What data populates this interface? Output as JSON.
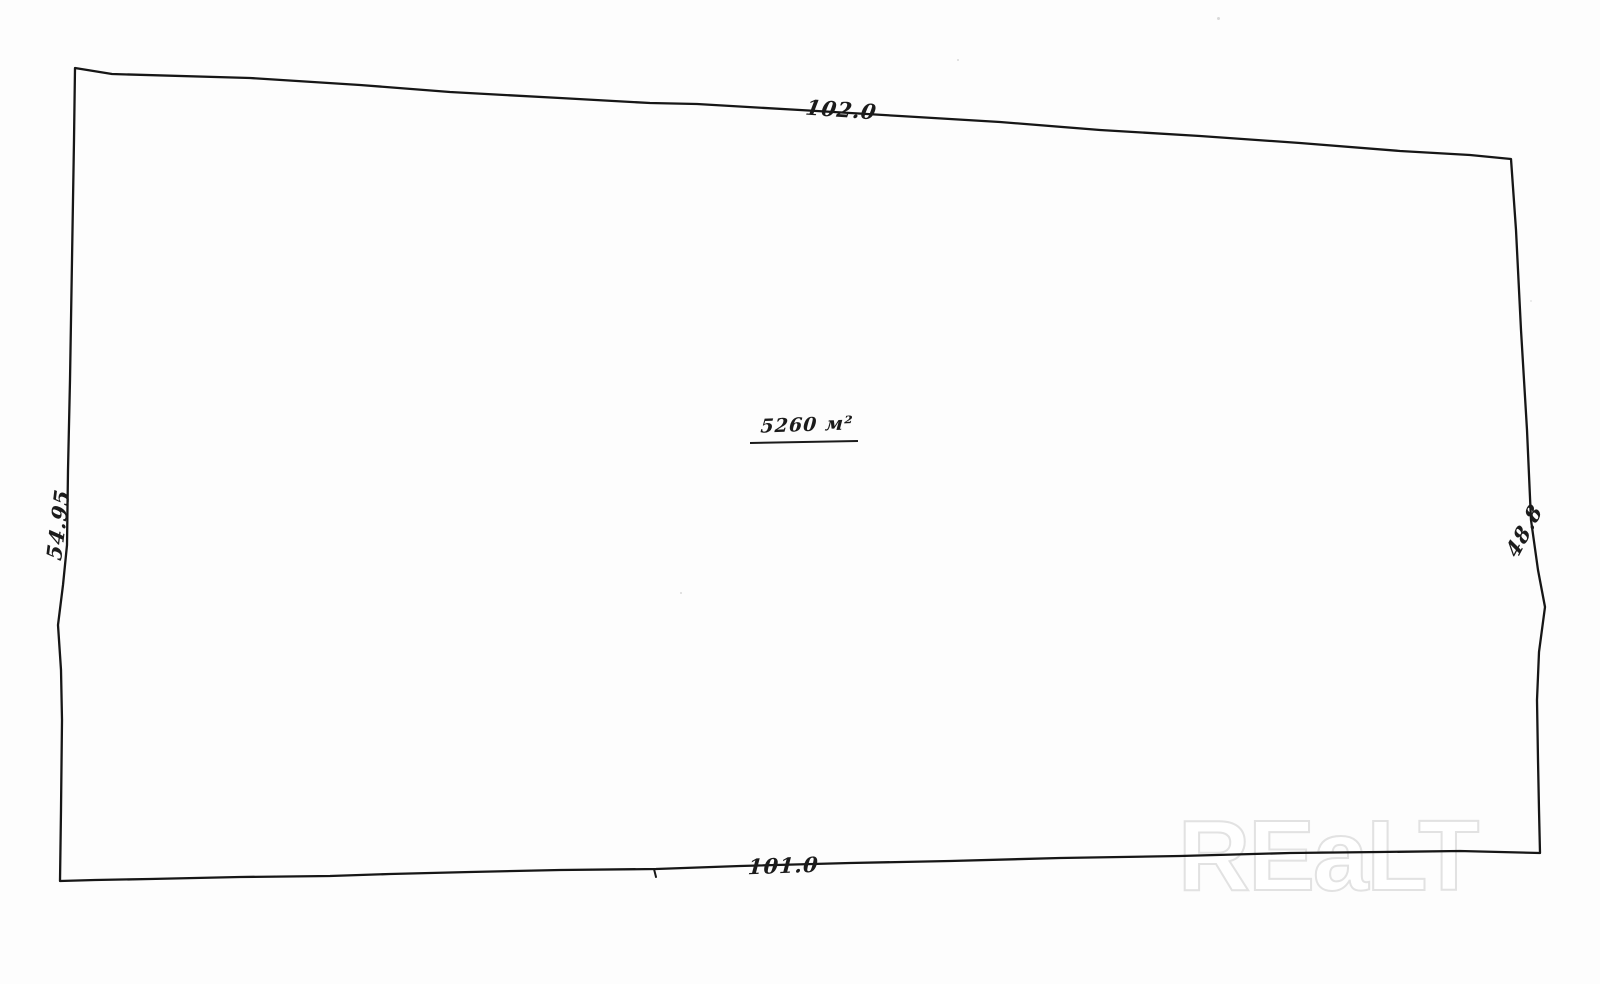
{
  "sketch": {
    "area_label": "5260 м²",
    "dimensions": {
      "top": "102.0",
      "bottom": "101.0",
      "left": "54.95",
      "right": "48.8"
    }
  },
  "watermark": {
    "text": "REaLT"
  }
}
